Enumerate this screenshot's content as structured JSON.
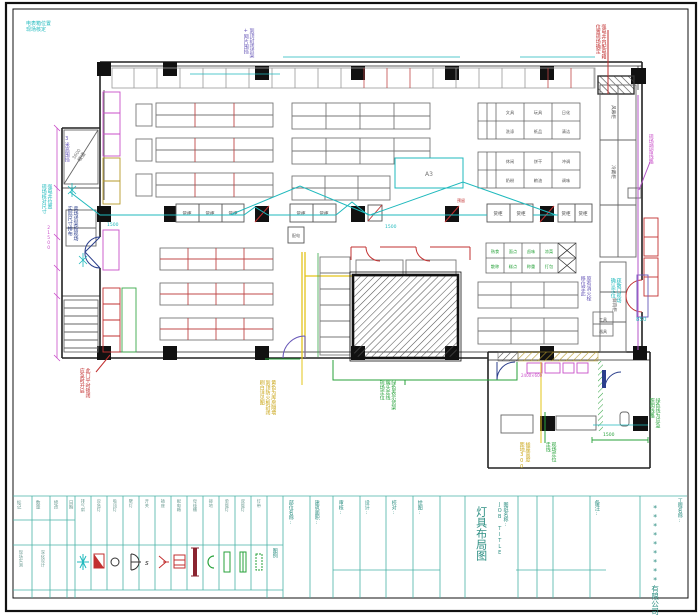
{
  "colors": {
    "wall": "#222222",
    "shelf": "#777777",
    "accent_red": "#c23030",
    "wiring_cyan": "#1fb9bd",
    "circuit_green": "#27a23a",
    "note_magenta": "#c94fc9",
    "note_purple": "#6858b8",
    "wall_yellow": "#e3c419",
    "titleblock_teal": "#2e8f83"
  },
  "annotations": [
    {
      "text": "电表箱位置\n现场核定"
    },
    {
      "text": "到顶封闭货架\n+网片围挡"
    },
    {
      "text": "3米高围挡"
    },
    {
      "text": "强电井位置\n现场核对尺寸"
    },
    {
      "text": "卖场货架按现场\n实际尺寸排布"
    },
    {
      "text": "此门平时锁闭\n应急时开启"
    },
    {
      "text": "强电井内配电箱\n位置现场确定"
    },
    {
      "text": "现场预留线路"
    },
    {
      "text": "原有消火栓\n移位至此"
    },
    {
      "text": "疏散门现场\n确认定位"
    },
    {
      "text": "850"
    },
    {
      "text": "绿色线为应急\n照明线路"
    },
    {
      "text": "插座高度\n距地300"
    },
    {
      "text": "现场定位\n走线"
    },
    {
      "text": "黄色为库房隔墙\n到顶防火板封闭\n刷白详见图"
    },
    {
      "text": "绿色表示货架\n端头走线\n现场定位"
    },
    {
      "text": "1500"
    },
    {
      "text": "1500"
    },
    {
      "text": "1500"
    },
    {
      "text": "3600"
    },
    {
      "text": "21500"
    },
    {
      "text": "2400×600"
    },
    {
      "text": "预留"
    }
  ],
  "plan": {
    "counter_labels": [
      "货柜",
      "货柜",
      "货柜",
      "货柜",
      "货柜",
      "货柜",
      "货柜",
      "货柜",
      "货柜"
    ],
    "grid_labels": [
      "文具",
      "玩具",
      "日化",
      "洗涤",
      "纸品",
      "清洁",
      "休闲",
      "饼干",
      "冲调",
      "奶粉",
      "粮油",
      "调味"
    ],
    "green_labels": [
      "熟食",
      "面点",
      "卤味",
      "凉菜",
      "散称",
      "糕点",
      "称重",
      "打包"
    ],
    "corridor_labels": [
      "风幕柜",
      "冷藏柜",
      "鲜肉柜"
    ],
    "box_labels": {
      "utility": "配电",
      "tool_top": "工具",
      "tool_bottom": "器具",
      "ramp": "坡道",
      "promo": "A3"
    }
  },
  "titleblock": {
    "revision_headers": [
      "标记",
      "数量",
      "修改",
      "日期"
    ],
    "revision_notes": [
      "现场实测",
      "深化设计"
    ],
    "legend_title": "图例",
    "legend_labels": [
      "排气扇",
      "应急灯",
      "吸顶灯",
      "壁灯",
      "开关",
      "插座",
      "配电箱",
      "母线槽",
      "接地",
      "单管灯",
      "双管灯",
      "灯带"
    ],
    "columns": [
      "部位名称:",
      "建筑面积:",
      "审核:",
      "设计:",
      "校对:",
      "绘图:"
    ],
    "remark_label": "备注:",
    "job_title": "图纸名称:\nJOB TITLE",
    "drawing_title": "灯具布局图",
    "project_label": "工程名称:",
    "company": "*********有限公司"
  }
}
